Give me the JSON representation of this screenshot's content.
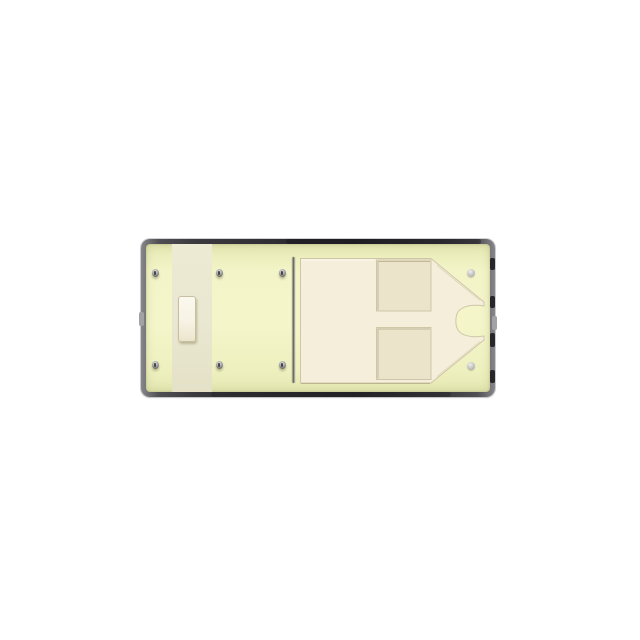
{
  "scene": {
    "background": "#ffffff",
    "subject": "electronic-component-top-view-render"
  },
  "component": {
    "terminal_pins": {
      "rows": 2,
      "cols": 3,
      "count": 6
    },
    "pivot_pins": {
      "count": 2
    },
    "has_divider_blade": true,
    "has_actuator_block": true,
    "armature_recesses": 2
  },
  "colors": {
    "page_bg": "#ffffff",
    "frame_dark": "#2e2e32",
    "frame_mid": "#3b3b3f",
    "frame_light": "#87878b",
    "frame_knot": "#17171b",
    "frame_latch": "#a2a2a6",
    "base_fill": "#f3f5c8",
    "base_edge": "#e5e7b2",
    "left_panel": "#eae8d1",
    "block_face": "#f7f3e5",
    "block_edge": "#c8bfa2",
    "mold_raised": "#f4eedb",
    "mold_recess": "#ebe4ca",
    "mold_edge": "#cfc6a8",
    "divider_dark": "#5e5e54",
    "divider_light": "#c3c3b6",
    "pin_body": "#9a9a9a",
    "pin_core": "#454545",
    "pin_bright": "#e2e2e2",
    "pivot_pin": "#c6c6c6"
  }
}
